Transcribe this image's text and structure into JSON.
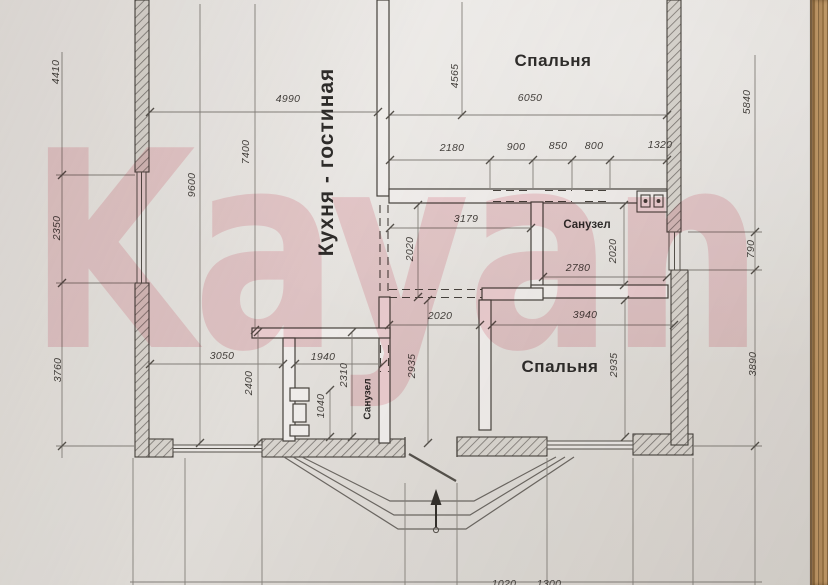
{
  "document": {
    "type_note": "scanned floor plan photo on wooden table",
    "watermark_text": "Kayan"
  },
  "colors": {
    "watermark_pink": "#f3bdc6",
    "paper": "#e9e6e3",
    "ink": "#46423c",
    "wood": "#b58e5e"
  },
  "rooms": {
    "kitchen_living": "Кухня - гостиная",
    "bedroom_top": "Спальня",
    "bedroom_bottom": "Спальня",
    "bathroom_mid": "Санузел",
    "bathroom_bottom": "Санузел"
  },
  "dimensions": {
    "left_top": "4410",
    "left_mid": "2350",
    "left_bottom": "3760",
    "interior_height": "9600",
    "kitchen_height": "7400",
    "kitchen_width": "4990",
    "bedroom_top_height": "4565",
    "bedroom_top_width": "6050",
    "seg_a": "2180",
    "seg_b": "900",
    "seg_c": "850",
    "seg_d": "800",
    "seg_e": "1320",
    "right_top": "5840",
    "right_mid": "790",
    "right_bottom": "3890",
    "hall_width": "3179",
    "hall_opening_height": "2020",
    "bath_mid_height": "2020",
    "bath_mid_width": "2780",
    "bedroom_bottom_opening": "2020",
    "bedroom_bottom_width": "3940",
    "bedroom_bottom_height_left": "2935",
    "bedroom_bottom_height_right": "2935",
    "kitchen_nook_width": "3050",
    "kitchen_nook_height": "2400",
    "bath_bottom_width": "1940",
    "bath_bottom_height": "2310",
    "bath_bottom_fixture": "1040",
    "bottom_cut_a": "1020",
    "bottom_cut_b": "1300"
  }
}
